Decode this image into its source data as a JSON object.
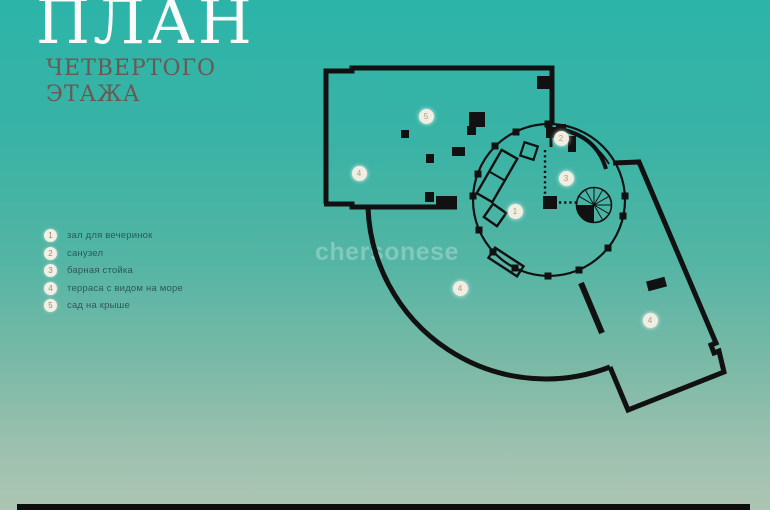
{
  "title": {
    "main": "ПЛАН",
    "subtitle_line1": "ЧЕТВЕРТОГО",
    "subtitle_line2": "ЭТАЖА"
  },
  "legend": {
    "items": [
      {
        "num": "1",
        "label": "зал для вечеринок"
      },
      {
        "num": "2",
        "label": "санузел"
      },
      {
        "num": "3",
        "label": "барная стойка"
      },
      {
        "num": "4",
        "label": "терраса с видом на море"
      },
      {
        "num": "5",
        "label": "сад на крыше"
      }
    ]
  },
  "watermark": "chersonese",
  "plan": {
    "markers": [
      {
        "num": "5"
      },
      {
        "num": "4"
      },
      {
        "num": "2"
      },
      {
        "num": "3"
      },
      {
        "num": "1"
      },
      {
        "num": "4"
      },
      {
        "num": "4"
      }
    ]
  },
  "colors": {
    "background_top": "#2cb4a9",
    "background_bottom": "#adc5b3",
    "title": "#fbfcfa",
    "subtitle": "#6d5751",
    "legend_text": "#2f575c",
    "plan_lines": "#111111",
    "marker_fill": "#f2ede1"
  }
}
